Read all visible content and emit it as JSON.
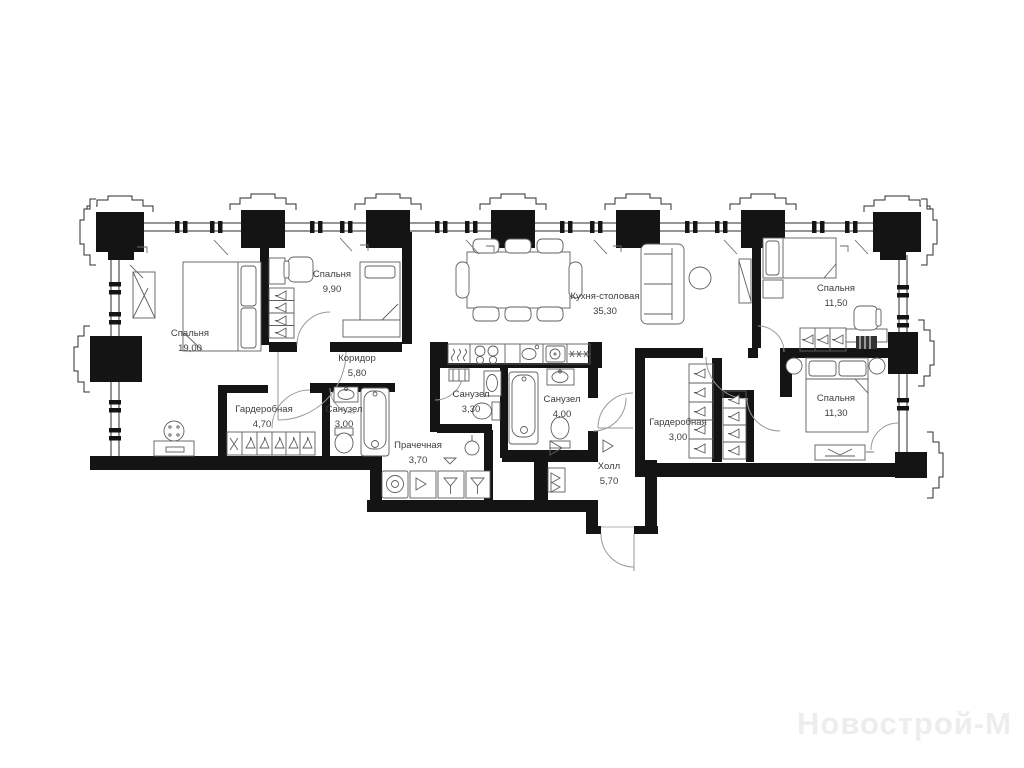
{
  "page": {
    "background": "#ffffff"
  },
  "watermark": {
    "text": "Новострой-М",
    "color": "#ededed"
  },
  "plan": {
    "wall_color": "#141414",
    "line_color": "#2e2e2e",
    "furniture_color": "#5f5f5f",
    "label_color": "#3d3d3d"
  },
  "rooms": [
    {
      "id": "bedroom-19",
      "name": "Спальня",
      "area": "19,00"
    },
    {
      "id": "bedroom-9-90",
      "name": "Спальня",
      "area": "9,90"
    },
    {
      "id": "corridor",
      "name": "Коридор",
      "area": "5,80"
    },
    {
      "id": "wardrobe-4-70",
      "name": "Гардеробная",
      "area": "4,70"
    },
    {
      "id": "bath-3-00",
      "name": "Санузел",
      "area": "3,00"
    },
    {
      "id": "laundry",
      "name": "Прачечная",
      "area": "3,70"
    },
    {
      "id": "bath-3-30",
      "name": "Санузел",
      "area": "3,30"
    },
    {
      "id": "bath-4-00",
      "name": "Санузел",
      "area": "4,00"
    },
    {
      "id": "kitchen-dining",
      "name": "Кухня-столовая",
      "area": "35,30"
    },
    {
      "id": "hall",
      "name": "Холл",
      "area": "5,70"
    },
    {
      "id": "wardrobe-3-00",
      "name": "Гардеробная",
      "area": "3,00"
    },
    {
      "id": "bedroom-11-50",
      "name": "Спальня",
      "area": "11,50"
    },
    {
      "id": "bedroom-11-30",
      "name": "Спальня",
      "area": "11,30"
    }
  ],
  "icons": [
    "double-bed",
    "single-bed",
    "wardrobe-hangers",
    "mirror-wardrobe",
    "round-table",
    "dresser",
    "desk",
    "office-chair",
    "dining-table",
    "dining-chair",
    "sofa",
    "coffee-table",
    "tv-unit",
    "kitchen-counter",
    "hob-burners",
    "kitchen-sink",
    "dishwasher",
    "freezer-asterisks",
    "bathtub",
    "toilet",
    "wash-sink",
    "washing-machine",
    "laundry-units",
    "shoe-cabinet",
    "door-arc",
    "entrance-door",
    "window-column",
    "window-mullion"
  ]
}
